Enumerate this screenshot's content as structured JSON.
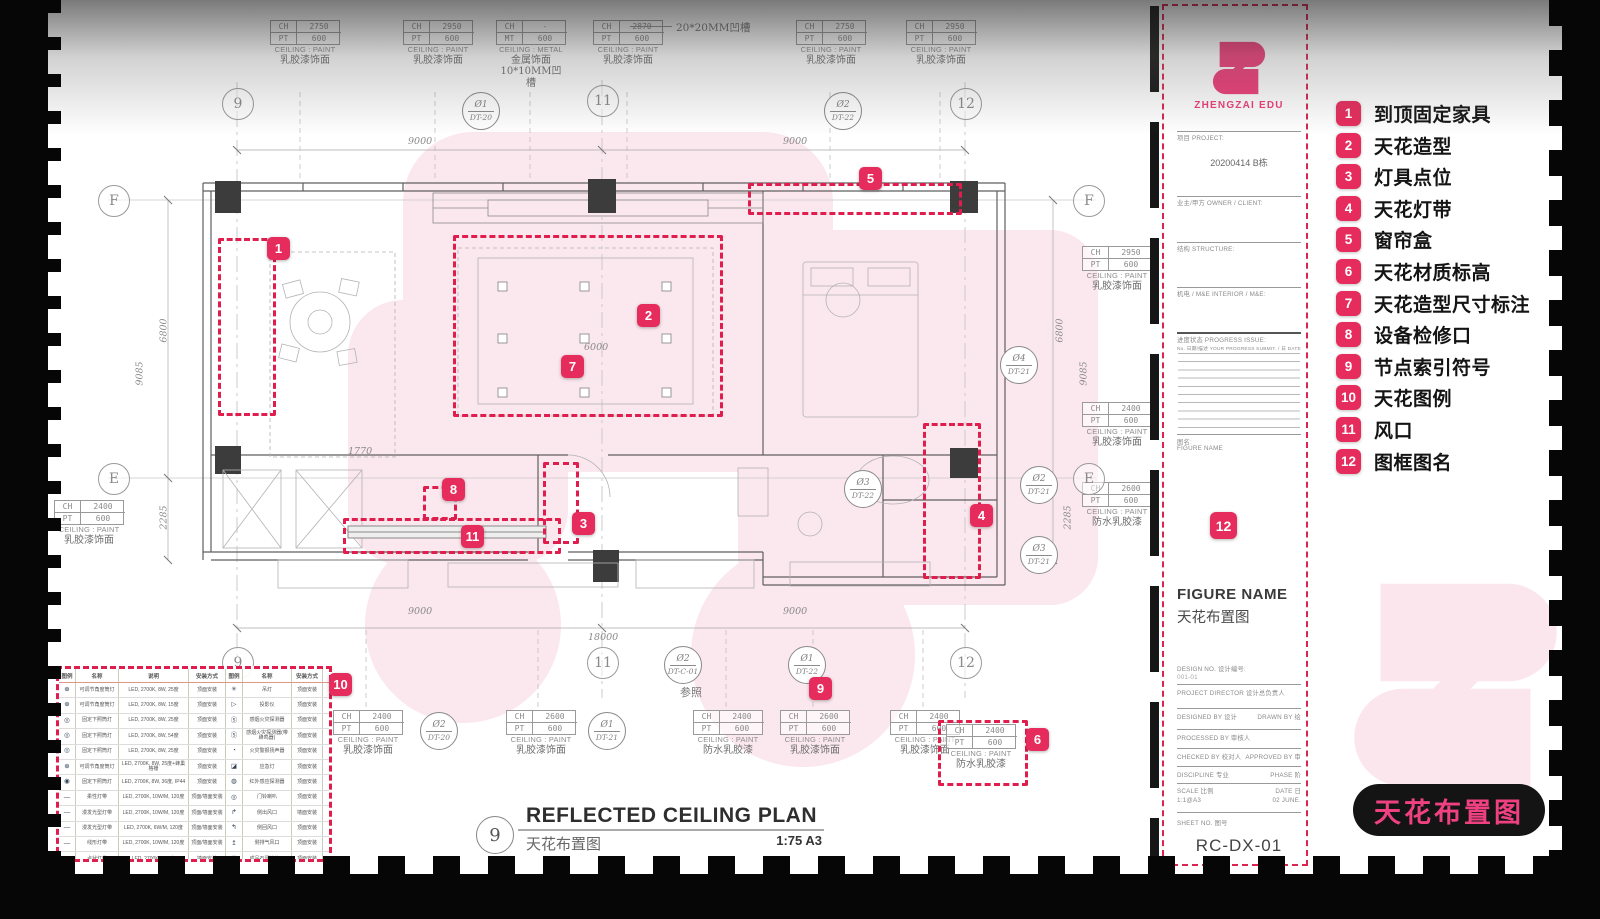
{
  "brand": {
    "name": "ZHENGZAI EDU",
    "pink": "#ee3d78",
    "badge_red": "#e62c5c"
  },
  "legend_panel": {
    "items": [
      {
        "n": "1",
        "label": "到顶固定家具"
      },
      {
        "n": "2",
        "label": "天花造型"
      },
      {
        "n": "3",
        "label": "灯具点位"
      },
      {
        "n": "4",
        "label": "天花灯带"
      },
      {
        "n": "5",
        "label": "窗帘盒"
      },
      {
        "n": "6",
        "label": "天花材质标高"
      },
      {
        "n": "7",
        "label": "天花造型尺寸标注"
      },
      {
        "n": "8",
        "label": "设备检修口"
      },
      {
        "n": "9",
        "label": "节点索引符号"
      },
      {
        "n": "10",
        "label": "天花图例"
      },
      {
        "n": "11",
        "label": "风口"
      },
      {
        "n": "12",
        "label": "图框图名"
      }
    ],
    "footer_tag": "天花布置图"
  },
  "title_block": {
    "brand": "ZHENGZAI EDU",
    "badge": "12",
    "project_label": "项目 PROJECT:",
    "project_value": "20200414 B栋",
    "owner_label": "业主/甲方 OWNER / CLIENT:",
    "structure_label": "结构 STRUCTURE:",
    "me_label": "机电 / M&E  INTERIOR / M&E:",
    "progress_label": "进度状态 PROGRESS ISSUE:",
    "progress_cols": "No.  日期/描述 YOUR PROGRESS SUBMIT.   / 日 DATE",
    "figure_label": "图名:",
    "figure_label2": "FIGURE NAME",
    "figure_en": "FIGURE NAME",
    "figure_cn": "天花布置图",
    "design_no_label": "DESIGN NO.  设计编号:",
    "design_no_value": "001-01",
    "director_label": "PROJECT DIRECTOR  设计总负责人",
    "designed_label": "DESIGNED BY  设计",
    "drawn_label": "DRAWN BY  绘",
    "processed_label": "PROCESSED BY  审核人",
    "checked_label": "CHECKED BY  校对人",
    "approved_label": "APPROVED BY  审",
    "discipline_label": "DISCIPLINE  专业",
    "phase_label": "PHASE  阶",
    "scale_label": "SCALE  比例",
    "scale_value": "1:1@A3",
    "date_label": "DATE  日",
    "date_value": "02 JUNE.",
    "sheet_label": "SHEET NO.  图号",
    "sheet_value": "RC-DX-01"
  },
  "plan": {
    "note_top": "20*20MM凹槽",
    "drawing_title": {
      "number": "9",
      "title_en": "REFLECTED CEILING PLAN",
      "title_cn": "天花布置图",
      "scale": "1:75 A3"
    },
    "bubbles": [
      {
        "x": 50,
        "y": 185,
        "label": "F"
      },
      {
        "x": 50,
        "y": 463,
        "label": "E"
      },
      {
        "x": 1025,
        "y": 185,
        "label": "F"
      },
      {
        "x": 1025,
        "y": 463,
        "label": "E"
      },
      {
        "x": 174,
        "y": 88,
        "label": "9"
      },
      {
        "x": 539,
        "y": 85,
        "label": "11"
      },
      {
        "x": 902,
        "y": 88,
        "label": "12"
      },
      {
        "x": 174,
        "y": 647,
        "label": "9"
      },
      {
        "x": 539,
        "y": 647,
        "label": "11"
      },
      {
        "x": 902,
        "y": 647,
        "label": "12"
      }
    ],
    "callouts": [
      {
        "x": 222,
        "y": 20,
        "k1": "CH",
        "v1": "2750",
        "k2": "PT",
        "v2": "600",
        "l1": "CEILING : PAINT",
        "l2": "乳胶漆饰面",
        "l3": ""
      },
      {
        "x": 355,
        "y": 20,
        "k1": "CH",
        "v1": "2950",
        "k2": "PT",
        "v2": "600",
        "l1": "CEILING : PAINT",
        "l2": "乳胶漆饰面",
        "l3": ""
      },
      {
        "x": 448,
        "y": 20,
        "k1": "CH",
        "v1": "-",
        "k2": "MT",
        "v2": "600",
        "l1": "CEILING : METAL",
        "l2": "金属饰面",
        "l3": "10*10MM凹槽"
      },
      {
        "x": 545,
        "y": 20,
        "k1": "CH",
        "v1": "2870",
        "k2": "PT",
        "v2": "600",
        "l1": "CEILING : PAINT",
        "l2": "乳胶漆饰面",
        "l3": ""
      },
      {
        "x": 748,
        "y": 20,
        "k1": "CH",
        "v1": "2750",
        "k2": "PT",
        "v2": "600",
        "l1": "CEILING : PAINT",
        "l2": "乳胶漆饰面",
        "l3": ""
      },
      {
        "x": 858,
        "y": 20,
        "k1": "CH",
        "v1": "2950",
        "k2": "PT",
        "v2": "600",
        "l1": "CEILING : PAINT",
        "l2": "乳胶漆饰面",
        "l3": ""
      },
      {
        "x": 1034,
        "y": 246,
        "k1": "CH",
        "v1": "2950",
        "k2": "PT",
        "v2": "600",
        "l1": "CEILING : PAINT",
        "l2": "乳胶漆饰面",
        "l3": ""
      },
      {
        "x": 1034,
        "y": 402,
        "k1": "CH",
        "v1": "2400",
        "k2": "PT",
        "v2": "600",
        "l1": "CEILING : PAINT",
        "l2": "乳胶漆饰面",
        "l3": ""
      },
      {
        "x": 1034,
        "y": 482,
        "k1": "CH",
        "v1": "2600",
        "k2": "PT",
        "v2": "600",
        "l1": "CEILING : PAINT",
        "l2": "防水乳胶漆",
        "l3": ""
      },
      {
        "x": 6,
        "y": 500,
        "k1": "CH",
        "v1": "2400",
        "k2": "PT",
        "v2": "600",
        "l1": "CEILING : PAINT",
        "l2": "乳胶漆饰面",
        "l3": ""
      },
      {
        "x": 285,
        "y": 710,
        "k1": "CH",
        "v1": "2400",
        "k2": "PT",
        "v2": "600",
        "l1": "CEILING : PAINT",
        "l2": "乳胶漆饰面",
        "l3": ""
      },
      {
        "x": 458,
        "y": 710,
        "k1": "CH",
        "v1": "2600",
        "k2": "PT",
        "v2": "600",
        "l1": "CEILING : PAINT",
        "l2": "乳胶漆饰面",
        "l3": ""
      },
      {
        "x": 645,
        "y": 710,
        "k1": "CH",
        "v1": "2400",
        "k2": "PT",
        "v2": "600",
        "l1": "CEILING : PAINT",
        "l2": "防水乳胶漆",
        "l3": ""
      },
      {
        "x": 732,
        "y": 710,
        "k1": "CH",
        "v1": "2600",
        "k2": "PT",
        "v2": "600",
        "l1": "CEILING : PAINT",
        "l2": "乳胶漆饰面",
        "l3": ""
      },
      {
        "x": 842,
        "y": 710,
        "k1": "CH",
        "v1": "2400",
        "k2": "PT",
        "v2": "600",
        "l1": "CEILING : PAINT",
        "l2": "乳胶漆饰面",
        "l3": ""
      },
      {
        "x": 898,
        "y": 724,
        "k1": "CH",
        "v1": "2400",
        "k2": "PT",
        "v2": "600",
        "l1": "CEILING : PAINT",
        "l2": "防水乳胶漆",
        "l3": ""
      }
    ],
    "markers": [
      {
        "x": 414,
        "y": 92,
        "top": "Ø1",
        "bottom": "DT-20",
        "cls": "right",
        "note": ""
      },
      {
        "x": 776,
        "y": 92,
        "top": "Ø2",
        "bottom": "DT-22",
        "cls": "left",
        "note": ""
      },
      {
        "x": 952,
        "y": 346,
        "top": "Ø4",
        "bottom": "DT-21",
        "cls": "left",
        "note": ""
      },
      {
        "x": 796,
        "y": 470,
        "top": "Ø3",
        "bottom": "DT-22",
        "cls": "left",
        "note": ""
      },
      {
        "x": 972,
        "y": 466,
        "top": "Ø2",
        "bottom": "DT-21",
        "cls": "left",
        "note": ""
      },
      {
        "x": 972,
        "y": 536,
        "top": "Ø3",
        "bottom": "DT-21",
        "cls": "left",
        "note": ""
      },
      {
        "x": 372,
        "y": 712,
        "top": "Ø2",
        "bottom": "DT-20",
        "cls": "right",
        "note": ""
      },
      {
        "x": 540,
        "y": 712,
        "top": "Ø1",
        "bottom": "DT-21",
        "cls": "right",
        "note": ""
      },
      {
        "x": 616,
        "y": 646,
        "top": "Ø2",
        "bottom": "DT-C-01",
        "cls": "right",
        "note": "参照"
      },
      {
        "x": 740,
        "y": 646,
        "top": "Ø1",
        "bottom": "DT-22",
        "cls": "right",
        "note": ""
      }
    ],
    "badges": [
      {
        "x": 219,
        "y": 237,
        "n": "1"
      },
      {
        "x": 589,
        "y": 304,
        "n": "2"
      },
      {
        "x": 513,
        "y": 355,
        "n": "7"
      },
      {
        "x": 524,
        "y": 512,
        "n": "3"
      },
      {
        "x": 394,
        "y": 478,
        "n": "8"
      },
      {
        "x": 413,
        "y": 525,
        "n": "11"
      },
      {
        "x": 811,
        "y": 167,
        "n": "5"
      },
      {
        "x": 922,
        "y": 504,
        "n": "4"
      },
      {
        "x": 978,
        "y": 728,
        "n": "6"
      },
      {
        "x": 761,
        "y": 677,
        "n": "9"
      },
      {
        "x": 281,
        "y": 673,
        "n": "10"
      }
    ],
    "redboxes": [
      {
        "x": 170,
        "y": 238,
        "w": 52,
        "h": 172
      },
      {
        "x": 405,
        "y": 235,
        "w": 264,
        "h": 176
      },
      {
        "x": 495,
        "y": 462,
        "w": 30,
        "h": 76
      },
      {
        "x": 700,
        "y": 183,
        "w": 208,
        "h": 26
      },
      {
        "x": 375,
        "y": 486,
        "w": 28,
        "h": 28
      },
      {
        "x": 295,
        "y": 518,
        "w": 212,
        "h": 30
      },
      {
        "x": 875,
        "y": 423,
        "w": 52,
        "h": 150
      },
      {
        "x": 890,
        "y": 720,
        "w": 84,
        "h": 60
      }
    ],
    "dims": [
      {
        "x": 360,
        "y": 136,
        "t": "9000"
      },
      {
        "x": 735,
        "y": 136,
        "t": "9000"
      },
      {
        "x": 536,
        "y": 342,
        "t": "6000"
      },
      {
        "x": 300,
        "y": 446,
        "t": "1770"
      },
      {
        "x": 360,
        "y": 606,
        "t": "9000"
      },
      {
        "x": 540,
        "y": 632,
        "t": "18000"
      },
      {
        "x": 735,
        "y": 606,
        "t": "9000"
      },
      {
        "x": 104,
        "y": 325,
        "t": "6800",
        "cls": "v"
      },
      {
        "x": 80,
        "y": 368,
        "t": "9085",
        "cls": "v"
      },
      {
        "x": 104,
        "y": 512,
        "t": "2285",
        "cls": "v"
      },
      {
        "x": 1000,
        "y": 325,
        "t": "6800",
        "cls": "v"
      },
      {
        "x": 1024,
        "y": 368,
        "t": "9085",
        "cls": "v"
      },
      {
        "x": 1008,
        "y": 512,
        "t": "2285",
        "cls": "v"
      }
    ]
  },
  "legend_table": {
    "headers": [
      "图例",
      "名称",
      "说明",
      "安装方式",
      "图例",
      "名称",
      "安装方式"
    ],
    "rows": [
      [
        "⊕",
        "可调节角度筒灯",
        "LED, 2700K, 8W, 25度",
        "顶面安装",
        "✳",
        "吊灯",
        "顶面安装"
      ],
      [
        "⊕",
        "可调节角度筒灯",
        "LED, 2700K, 8W, 15度",
        "顶面安装",
        "▷",
        "投影仪",
        "顶面安装"
      ],
      [
        "◎",
        "固定下照筒灯",
        "LED, 2700K, 8W, 25度",
        "顶面安装",
        "Ⓢ",
        "感烟火灾探测器",
        "顶面安装"
      ],
      [
        "◎",
        "固定下照筒灯",
        "LED, 2700K, 8W, 54度",
        "顶面安装",
        "Ⓢ",
        "感烟火灾探测器(带蜂鸣器)",
        "顶面安装"
      ],
      [
        "◎",
        "固定下照筒灯",
        "LED, 2700K, 8W, 25度",
        "顶面安装",
        "◔",
        "火灾警报扬声器",
        "顶面安装"
      ],
      [
        "⊕",
        "可调节角度筒灯",
        "LED, 2700K, 8W, 25度+蜂巢格栅",
        "顶面安装",
        "◪",
        "应急灯",
        "顶面安装"
      ],
      [
        "◉",
        "固定下照筒灯",
        "LED, 2700K, 8W, 36度, IP44",
        "顶面安装",
        "◍",
        "红外感应探测器",
        "顶面安装"
      ],
      [
        "—",
        "柔性灯带",
        "LED, 2700K, 10W/M, 120度",
        "顶面/墙面安装",
        "◎",
        "门铃喇叭",
        "顶面安装"
      ],
      [
        "—",
        "漫发光型灯带",
        "LED, 2700K, 10W/M, 120度",
        "顶面/墙面安装",
        "↱",
        "侧出风口",
        "墙面安装"
      ],
      [
        "—",
        "漫发光型灯带",
        "LED, 2700K, 6W/M, 120度",
        "顶面/墙面安装",
        "↰",
        "侧回风口",
        "顶面安装"
      ],
      [
        "—",
        "线形灯带",
        "LED, 2700K, 10W/M, 120度",
        "顶面/墙面安装",
        "↥",
        "侧排气风口",
        "顶面安装"
      ],
      [
        "—",
        "点状灯带",
        "LED, 2700K, 1W/个",
        "墙面安装",
        "⊠",
        "成品石膏检修口",
        "顶面安装"
      ]
    ]
  }
}
